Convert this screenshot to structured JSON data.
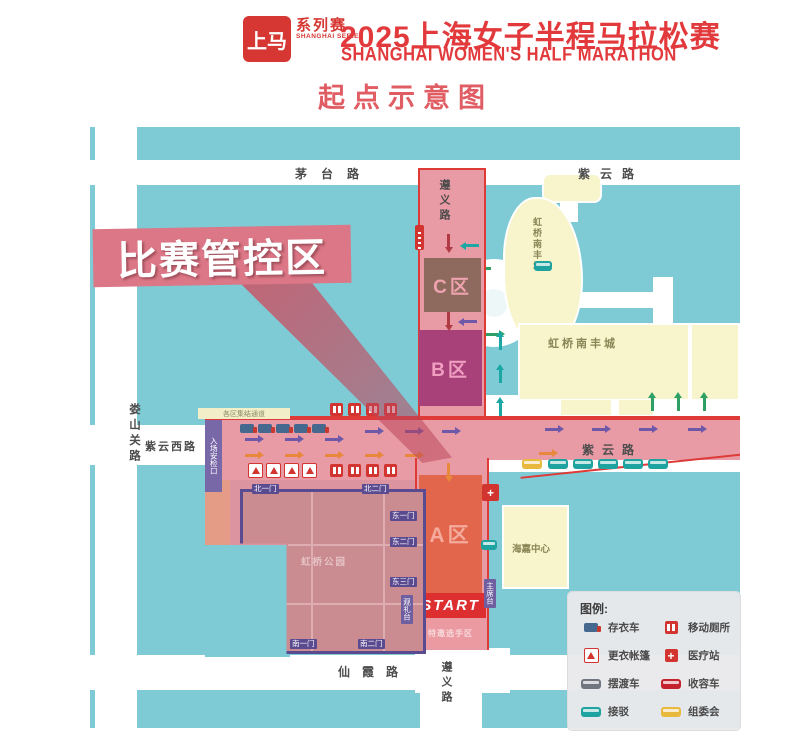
{
  "header": {
    "seal_text": "上马",
    "series_label": "系列赛",
    "series_sub": "SHANGHAI SERIES",
    "title_cn": "2025上海女子半程马拉松赛",
    "title_en": "SHANGHAI WOMEN'S HALF MARATHON",
    "subtitle": "起点示意图"
  },
  "map": {
    "control_banner": "比赛管控区",
    "roads": {
      "maotai": "茅台路",
      "ziyun_ne": "紫云路",
      "loushanguan": "娄山关路",
      "ziyun_west": "紫云西路",
      "ziyun_east": "紫云路",
      "xianxia": "仙霞路",
      "zunyi_north": "遵义路",
      "zunyi_south": "遵义路"
    },
    "zones": {
      "c_zone": "C区",
      "b_zone": "B区",
      "a_zone": "A区",
      "start": "START",
      "vip": "特邀选手区",
      "security": "入场安检口",
      "corridor_note": "各区集结通道"
    },
    "buildings": {
      "nanfeng_north": "虹桥南丰城",
      "nanfeng_south": "虹桥南丰城",
      "haijia": "海嘉中心",
      "park": "虹桥公园"
    },
    "gates": {
      "north1": "北一门",
      "north2": "北二门",
      "east1": "东一门",
      "east2": "东二门",
      "east3": "东三门",
      "south1": "南一门",
      "south2": "南二门"
    },
    "stands": {
      "chairman": "主席台",
      "viewing": "观礼台"
    }
  },
  "legend": {
    "title": "图例:",
    "items": [
      {
        "label": "存衣车",
        "icon": "baggage-truck-icon",
        "color": "#44688e"
      },
      {
        "label": "移动厕所",
        "icon": "mobile-toilet-icon",
        "color": "#d23430"
      },
      {
        "label": "更衣帐篷",
        "icon": "changing-tent-icon",
        "color": "#d23430"
      },
      {
        "label": "医疗站",
        "icon": "medical-station-icon",
        "color": "#d23430"
      },
      {
        "label": "摆渡车",
        "icon": "shuttle-bus-icon",
        "color": "#6f7680"
      },
      {
        "label": "收容车",
        "icon": "sweep-bus-icon",
        "color": "#c4232e"
      },
      {
        "label": "接驳",
        "icon": "transfer-bus-icon",
        "color": "#1fa3a0"
      },
      {
        "label": "组委会",
        "icon": "committee-bus-icon",
        "color": "#e9b93d"
      }
    ]
  }
}
